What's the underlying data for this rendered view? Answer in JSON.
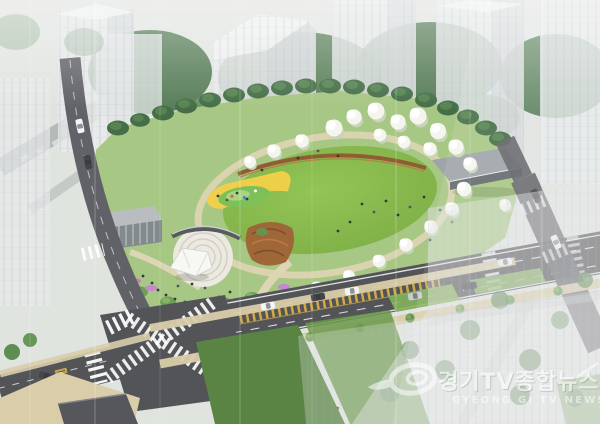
{
  "watermark": {
    "logo_icon": "gyeonggi-tv-swirl-logo-icon",
    "title_korean": "경기TV종합뉴스",
    "subtitle_english": "GYEONG GI TV NEWS"
  },
  "palette": {
    "backdrop": "#e3e6e2",
    "ghost_building": "#e6e8ea",
    "ghost_shade": "#c9cdd0",
    "facade_line": "#b4bac0",
    "tree_dark": "#3f6a40",
    "tree_mid": "#5f9147",
    "shrub_green": "#679a4b",
    "lawn_green": "#8cc24d",
    "lawn_shade": "#76a83c",
    "field_green": "#527e39",
    "park_base": "#a3c47e",
    "path_tan": "#ddd3b0",
    "road_asphalt": "#4a4b4f",
    "road_light": "#595a5f",
    "lane_marking": "#ffffff",
    "median_yellow": "#e5b63c",
    "sidewalk_tan": "#d8cba6",
    "plaza_stone": "#ebe8e0",
    "plaza_ring": "#d2cec2",
    "canopy_white": "#f7f7f4",
    "pergola_dark": "#4f5356",
    "wood_brown": "#9a5f2e",
    "seat_wall_brown": "#8a5526",
    "play_yellow": "#f3cd3f",
    "play_green": "#76bd4f",
    "flower_purple": "#c47fd0",
    "flower_magenta": "#cc6fc4",
    "building_roof": "#b6babc",
    "building_wall": "#7d8487",
    "pavilion_roof": "#99a0a3",
    "car_white": "#f4f5f6",
    "car_dark": "#3a3d43",
    "car_silver": "#c7cbd0",
    "pedestrian_dark": "#2c2f33",
    "watermark_white": "#ffffff"
  }
}
